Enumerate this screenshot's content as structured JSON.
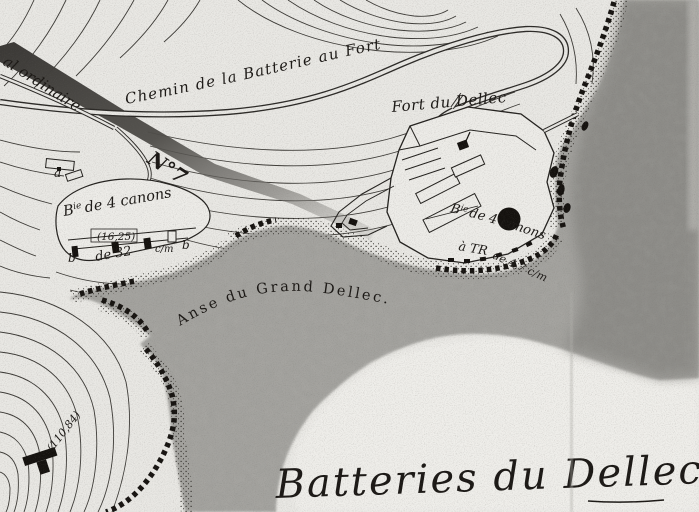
{
  "map": {
    "title": "Batteries du Dellec (scanned historical map)",
    "labels": {
      "chemin": "Chemin de la Batterie au Fort",
      "road_no7_prefix": "al ordinaire",
      "road_no7": "N°7",
      "fort": "Fort du Dellec",
      "anse": "Anse du Grand Dellec.",
      "elevation": "(110,84)",
      "handwriting": "Batteries du Dellec",
      "battery_left": {
        "b_init": "B",
        "sup": "ie",
        "rest": "de 4 canons",
        "height": "(16,25)",
        "b_left": "b",
        "caliber": "de 32",
        "cm": "c/m",
        "b_right": "b",
        "a": "a"
      },
      "battery_right": {
        "b_init": "B",
        "sup": "ie",
        "rest": "de 4 canons",
        "line2": "à TR",
        "line3": "de 4,7 c/m"
      }
    },
    "colors": {
      "paper": "#e9e8e4",
      "paper_light": "#edece8",
      "water": "#a5a4a0",
      "water_dark": "#8b8a86",
      "ink": "#1b1815"
    }
  }
}
